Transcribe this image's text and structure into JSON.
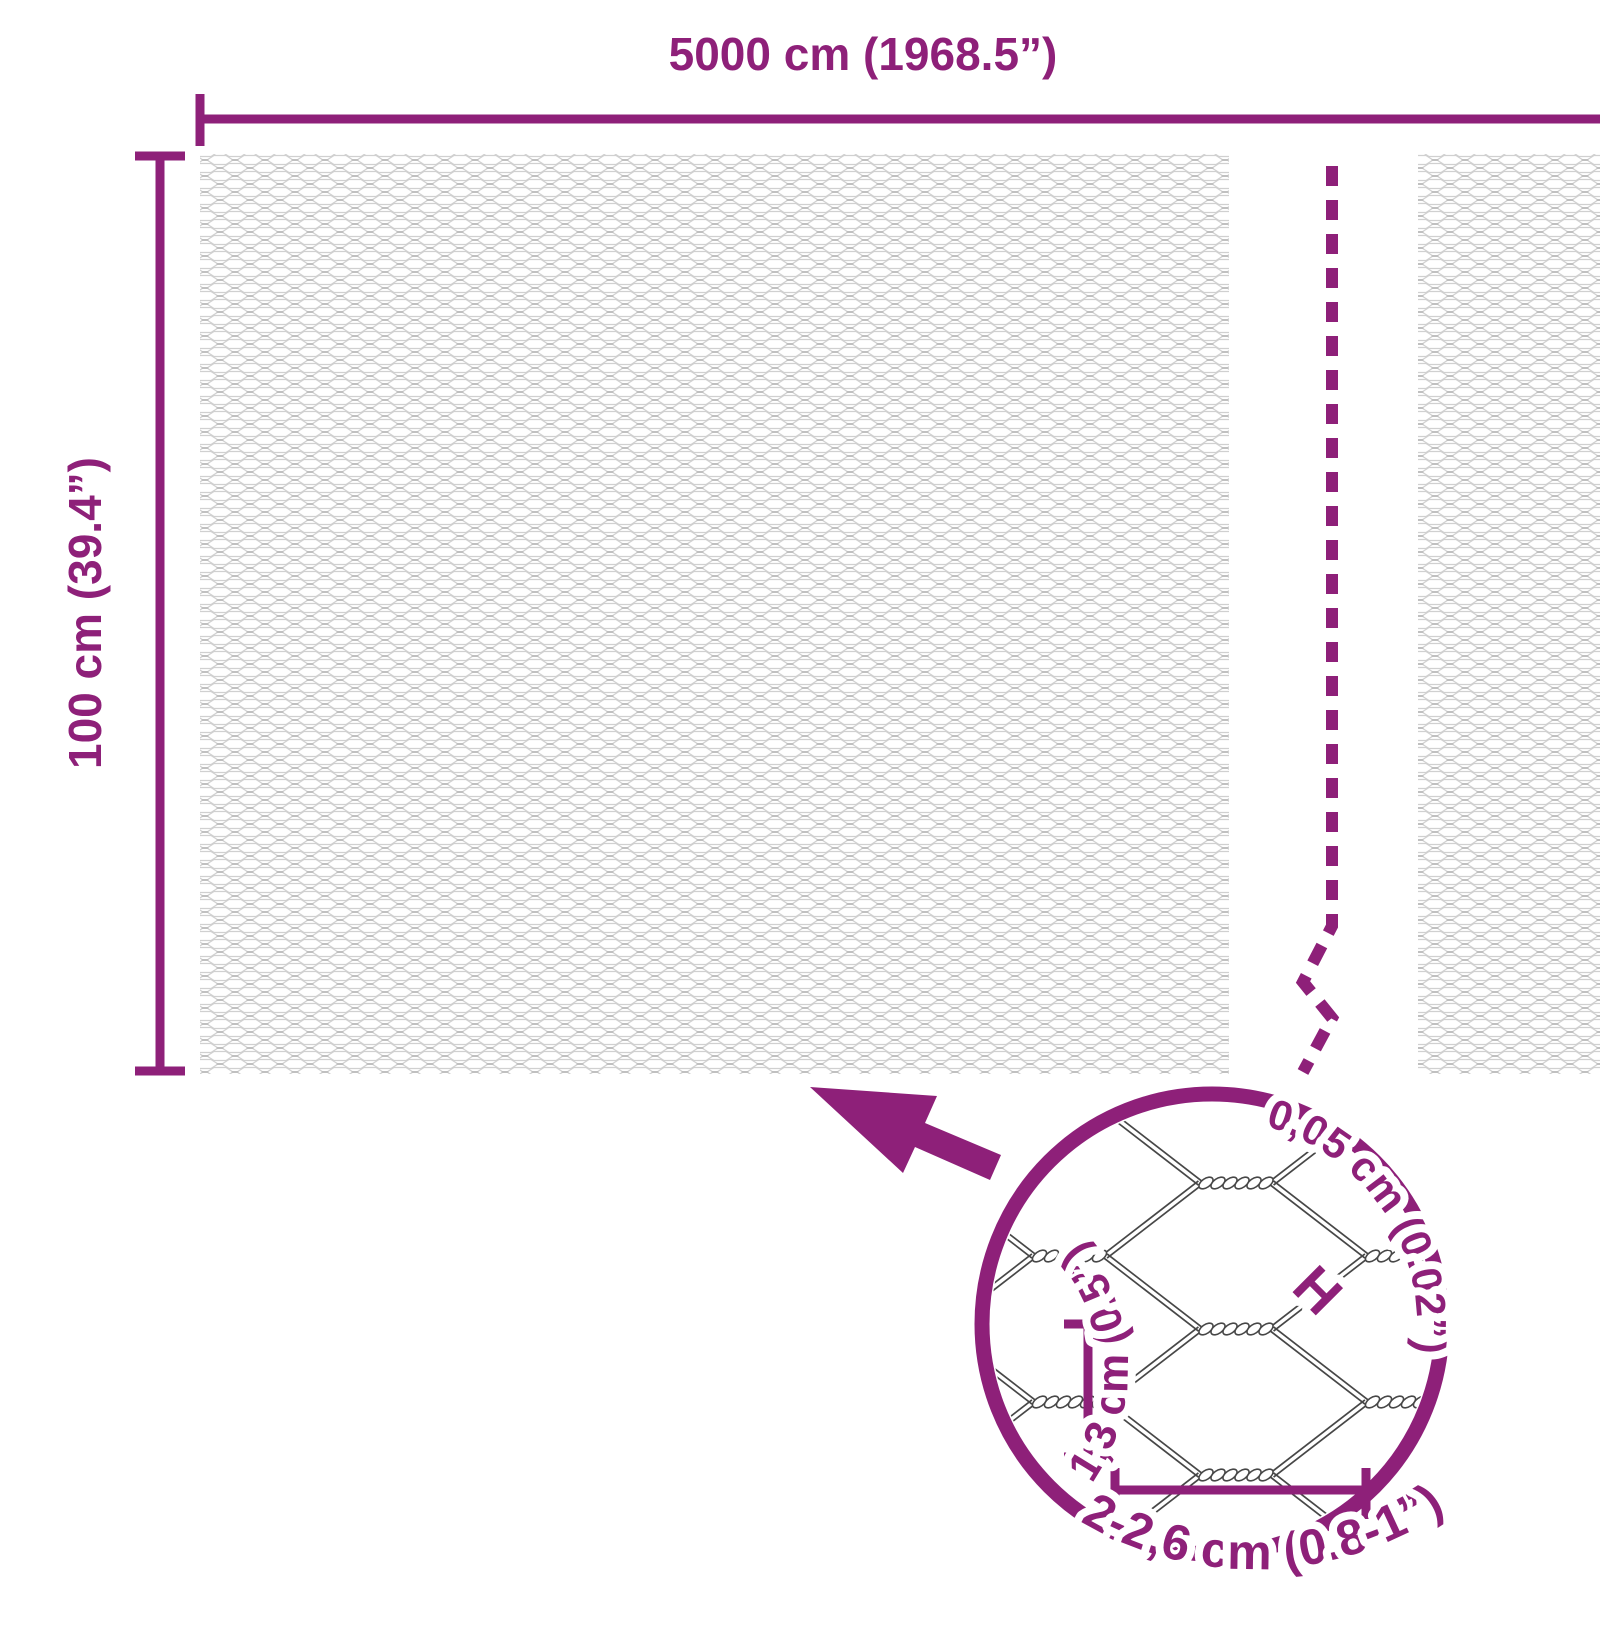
{
  "colors": {
    "accent": "#8E2079",
    "mesh_line": "#d0d0d0",
    "mesh_twist": "#c0c0c0",
    "wire_line": "#474747"
  },
  "dimensions": {
    "width_label": "5000 cm (1968.5”)",
    "height_label": "100 cm (39.4”)"
  },
  "magnifier": {
    "wire_thickness_label": "0,05 cm (0.02”)",
    "wire_marker": "H",
    "cell_height_label": "1,3 cm (0.5”)",
    "cell_width_label": "2-2,6 cm (0.8-1”)"
  }
}
